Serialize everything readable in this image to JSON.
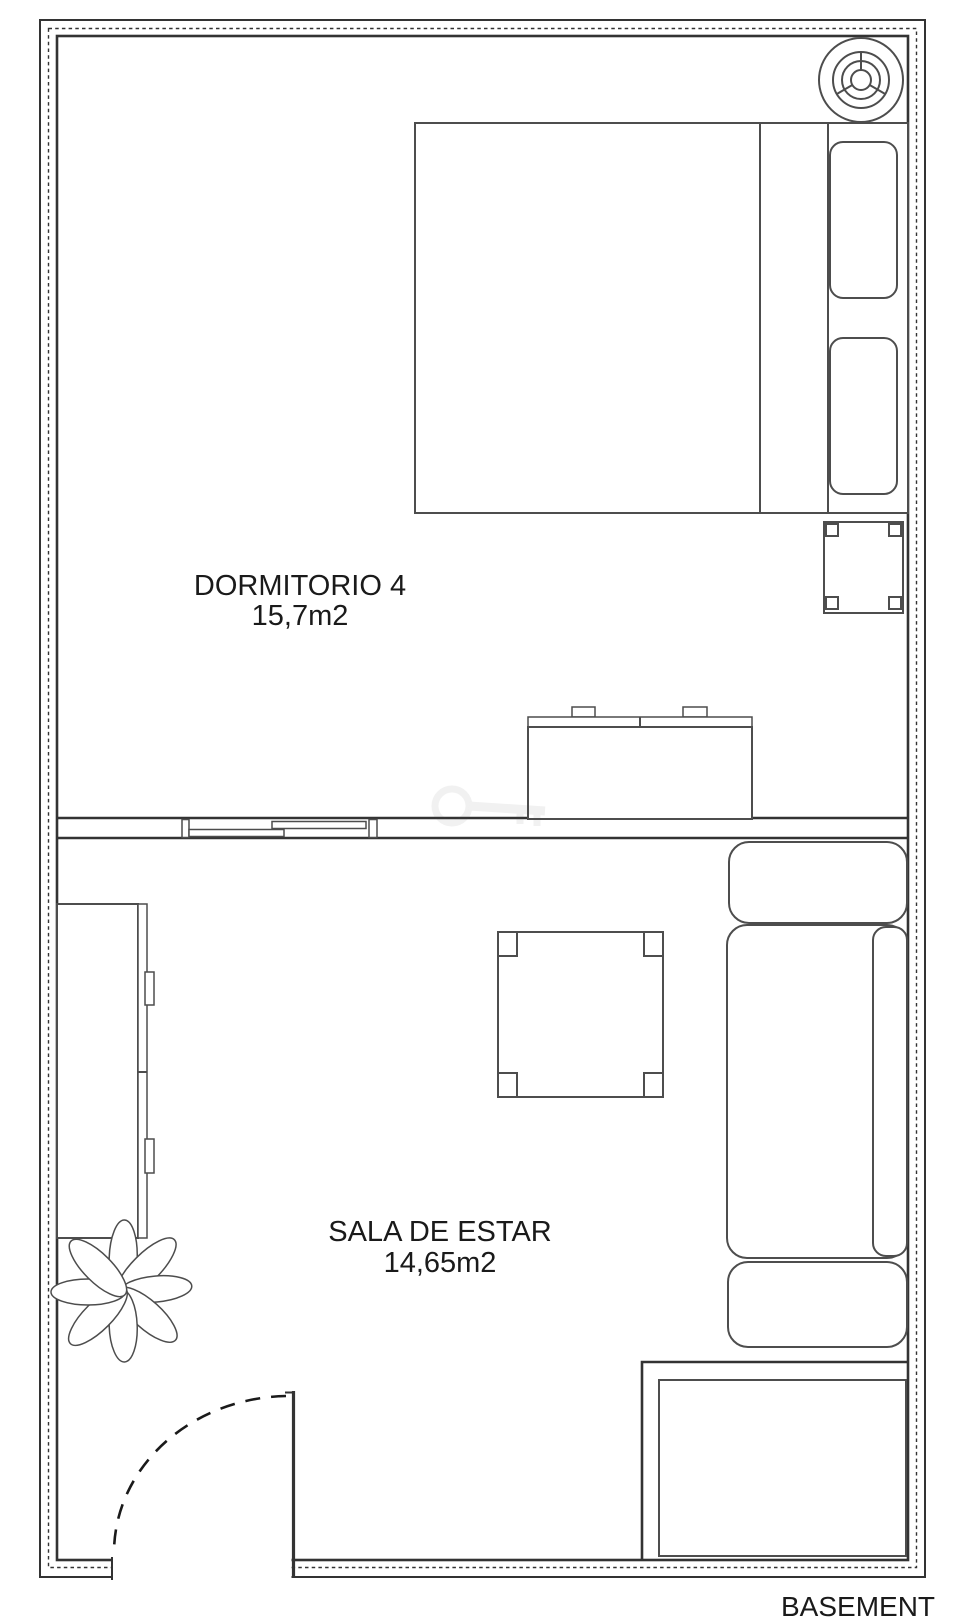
{
  "rooms": [
    {
      "name": "DORMITORIO 4",
      "area": "15,7m2"
    },
    {
      "name": "SALA DE ESTAR",
      "area": "14,65m2"
    }
  ],
  "caption": "BASEMENT",
  "colors": {
    "wall": "#333333",
    "furn": "#4d4d4d",
    "text": "#1a1a1a",
    "background": "#ffffff"
  }
}
